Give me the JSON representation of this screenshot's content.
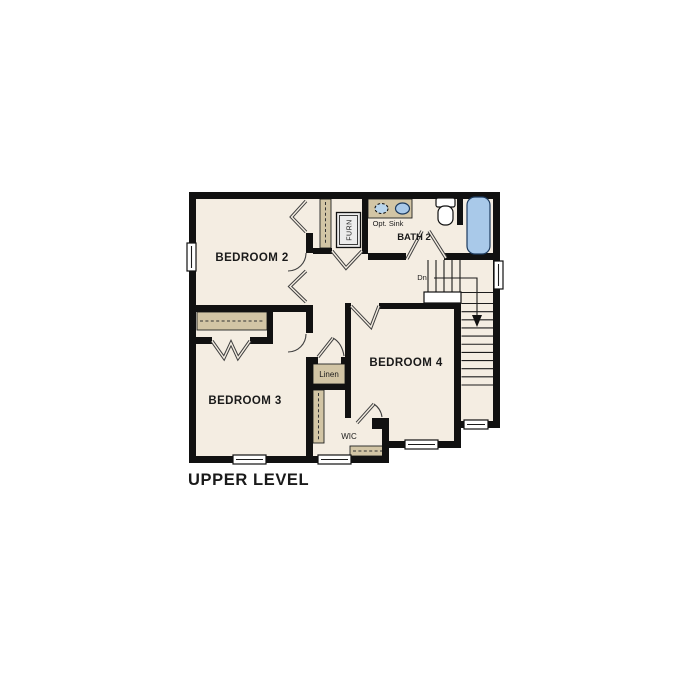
{
  "plan_title": "UPPER LEVEL",
  "rooms": [
    {
      "id": "bedroom-2",
      "label": "BEDROOM 2"
    },
    {
      "id": "bedroom-3",
      "label": "BEDROOM 3"
    },
    {
      "id": "bedroom-4",
      "label": "BEDROOM 4"
    },
    {
      "id": "bath-2",
      "label": "BATH 2"
    },
    {
      "id": "wic",
      "label": "WIC"
    },
    {
      "id": "linen",
      "label": "Linen"
    }
  ],
  "labels": {
    "optional_sink": "Opt. Sink",
    "furnace": "FURN",
    "stairs_down": "Dn"
  },
  "stairs": {
    "direction_label": "Dn",
    "upper_tread_count": 5,
    "lower_tread_count": 11
  },
  "colors": {
    "wall": "#111111",
    "floor": "#f4ede2",
    "closet": "#d2c5a5",
    "water": "#a9c9e9",
    "water-light": "#b9d5ec",
    "text": "#1a1a1a",
    "bg": "#ffffff",
    "doorline": "#3f3f3f"
  }
}
